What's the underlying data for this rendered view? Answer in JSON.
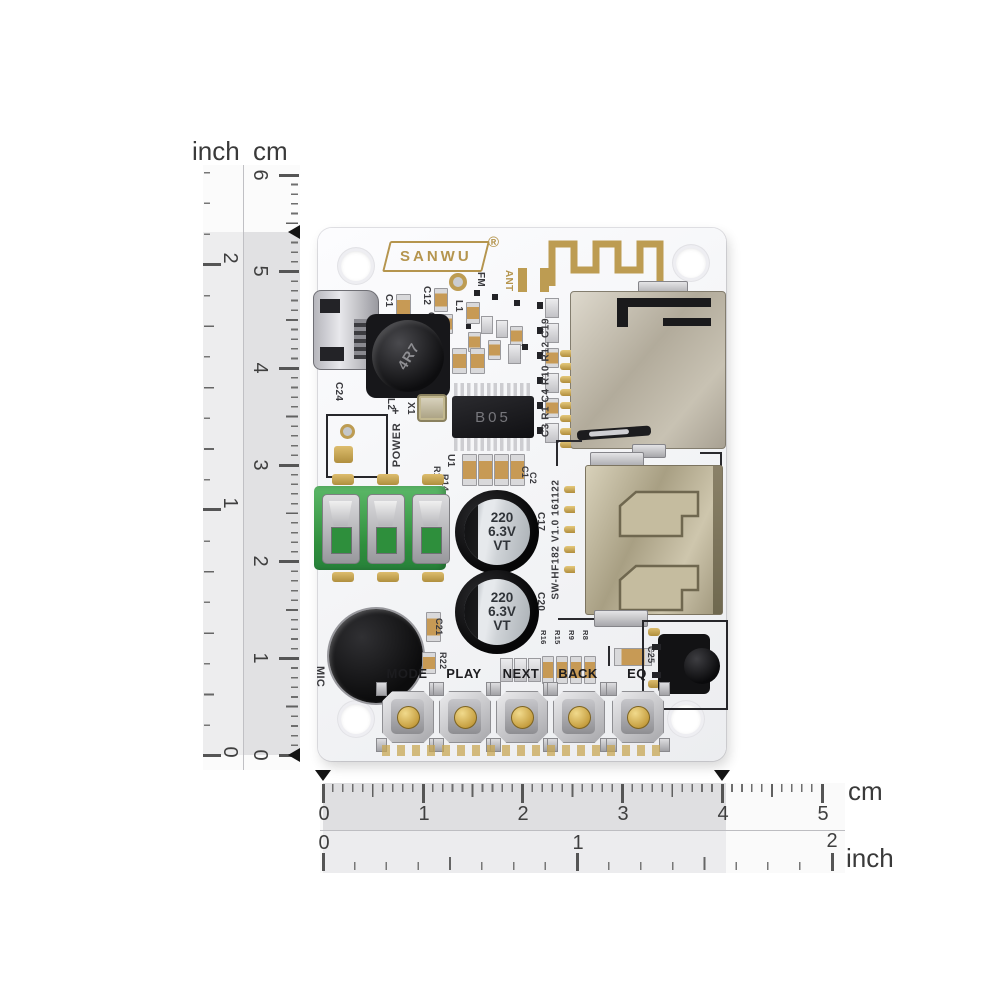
{
  "rulers": {
    "vertical": {
      "inch_label": "inch",
      "cm_label": "cm",
      "cm": [
        "6",
        "5",
        "4",
        "3",
        "2",
        "1",
        "0"
      ],
      "inch": [
        "2",
        "1",
        "0"
      ]
    },
    "horizontal": {
      "cm_label": "cm",
      "inch_label": "inch",
      "cm": [
        "0",
        "1",
        "2",
        "3",
        "4",
        "5"
      ],
      "inch": [
        "0",
        "1",
        "2"
      ]
    }
  },
  "pcb": {
    "brand": "SANWU",
    "brand_reg": "®",
    "ic_text": "B05",
    "inductor_text": "4R7",
    "cap_line1": "220",
    "cap_line2": "6.3V",
    "cap_line3": "VT",
    "buttons": [
      "MODE",
      "PLAY",
      "NEXT",
      "BACK",
      "EQ"
    ],
    "labels": {
      "fm": "FM",
      "ant": "ANT",
      "c1": "C1",
      "c12": "C12",
      "c13": "C13",
      "l1": "L1",
      "c24": "C24",
      "l2": "L2",
      "x1": "X1",
      "u1": "U1",
      "r17": "R17",
      "r14": "R14",
      "c1b": "C1",
      "c2": "C2",
      "right_column": "C3 R1 C4 R10 R12 C19",
      "model": "SW-HF182 V1.0 161122",
      "power": "POWER",
      "plus": "+",
      "minus": "-",
      "c17": "C17",
      "c20": "C20",
      "c21": "C21",
      "r22": "R22",
      "mic": "MIC",
      "c25": "C25",
      "cluster": [
        "R16",
        "R15",
        "R9",
        "R8"
      ]
    }
  },
  "colors": {
    "gold": "#b5954e",
    "board": "#f5f5f7",
    "jack_green": "#3fa24c",
    "band_dark": "#e0e0e0",
    "band_light": "#ededed",
    "marker": "#141414"
  }
}
